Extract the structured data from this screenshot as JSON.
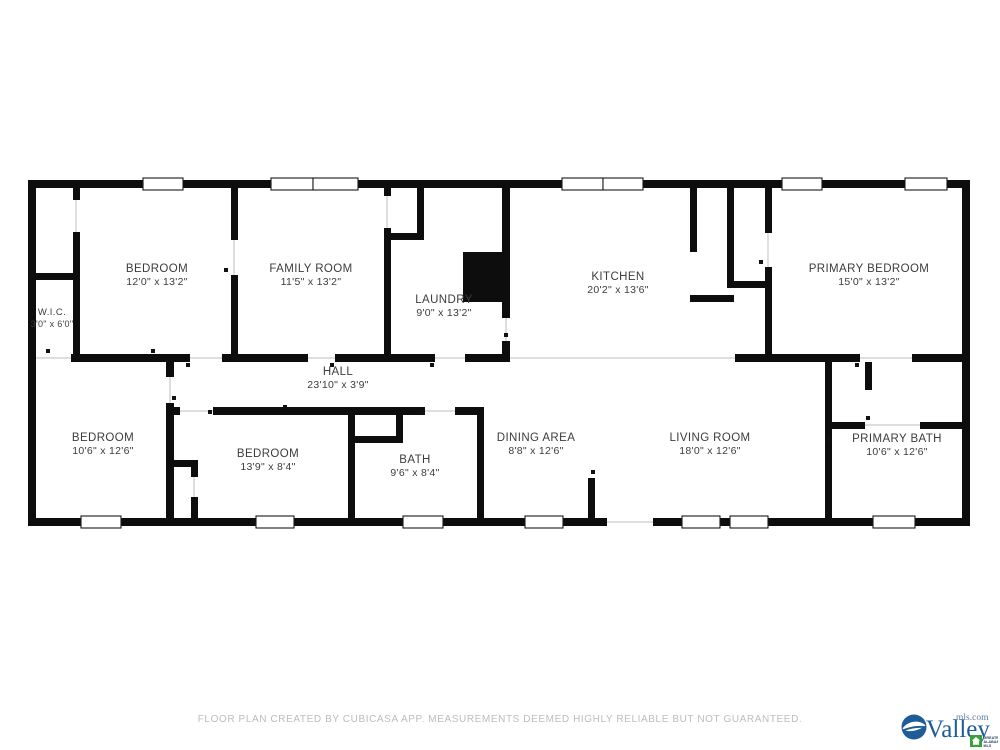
{
  "plan": {
    "rooms": [
      {
        "name": "BEDROOM",
        "dims": "12'0\" x 13'2\""
      },
      {
        "name": "FAMILY ROOM",
        "dims": "11'5\" x 13'2\""
      },
      {
        "name": "LAUNDRY",
        "dims": "9'0\" x 13'2\""
      },
      {
        "name": "KITCHEN",
        "dims": "20'2\" x 13'6\""
      },
      {
        "name": "PRIMARY BEDROOM",
        "dims": "15'0\" x 13'2\""
      },
      {
        "name": "W.I.C.",
        "dims": "3'0\" x 6'0\""
      },
      {
        "name": "HALL",
        "dims": "23'10\" x 3'9\""
      },
      {
        "name": "BEDROOM",
        "dims": "10'6\" x 12'6\""
      },
      {
        "name": "BEDROOM",
        "dims": "13'9\" x 8'4\""
      },
      {
        "name": "BATH",
        "dims": "9'6\" x 8'4\""
      },
      {
        "name": "DINING AREA",
        "dims": "8'8\" x 12'6\""
      },
      {
        "name": "LIVING ROOM",
        "dims": "18'0\" x 12'6\""
      },
      {
        "name": "PRIMARY BATH",
        "dims": "10'6\" x 12'6\""
      }
    ]
  },
  "footer": {
    "disclaimer": "FLOOR PLAN CREATED BY CUBICASA APP. MEASUREMENTS DEEMED HIGHLY RELIABLE BUT NOT GUARANTEED."
  },
  "logo": {
    "brand": "Valley",
    "domain": "mls.com",
    "badge_line1": "GREATER",
    "badge_line2": "ALABAMA",
    "badge_line3": "MLS",
    "brand_color": "#1e5c97",
    "badge_color": "#36a23d"
  },
  "colors": {
    "wall": "#0d0d0d",
    "room_label": "#3c3c3c",
    "disclaimer": "#bcbcbc"
  }
}
